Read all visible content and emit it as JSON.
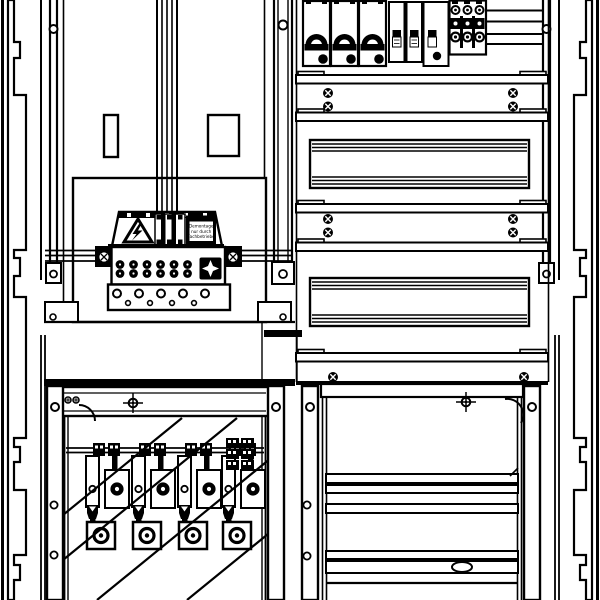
{
  "drawing": {
    "kind": "electrical-cabinet-front-view",
    "colors": {
      "line": "#000000",
      "background": "#ffffff"
    },
    "warning_label": {
      "icon": "high-voltage-warning-triangle",
      "line1": "Demontage",
      "line2": "nur durch",
      "line3": "Fachbetriebe"
    },
    "components": {
      "top_right_bay": {
        "mcb_3pole_count": 3,
        "narrow_din_modules": 3,
        "terminal_block_poles": 3,
        "mounting_rails": 5,
        "din_rail_panels": 2,
        "rail_screw_pairs": 5
      },
      "top_left_bay": {
        "busbar_riser_bars": 4,
        "panel_cutouts": 2,
        "terminal_clamps_figure8": 6,
        "star_screw_terminals": 1,
        "wire_outlet_holes_large": 5,
        "wire_outlet_holes_small": 4
      },
      "bottom_left_bay": {
        "fuse_switch_strips": 4,
        "cable_runs": 4
      },
      "bottom_right_bay": {
        "crossbars": 3,
        "oval_knockout": 1
      }
    }
  }
}
